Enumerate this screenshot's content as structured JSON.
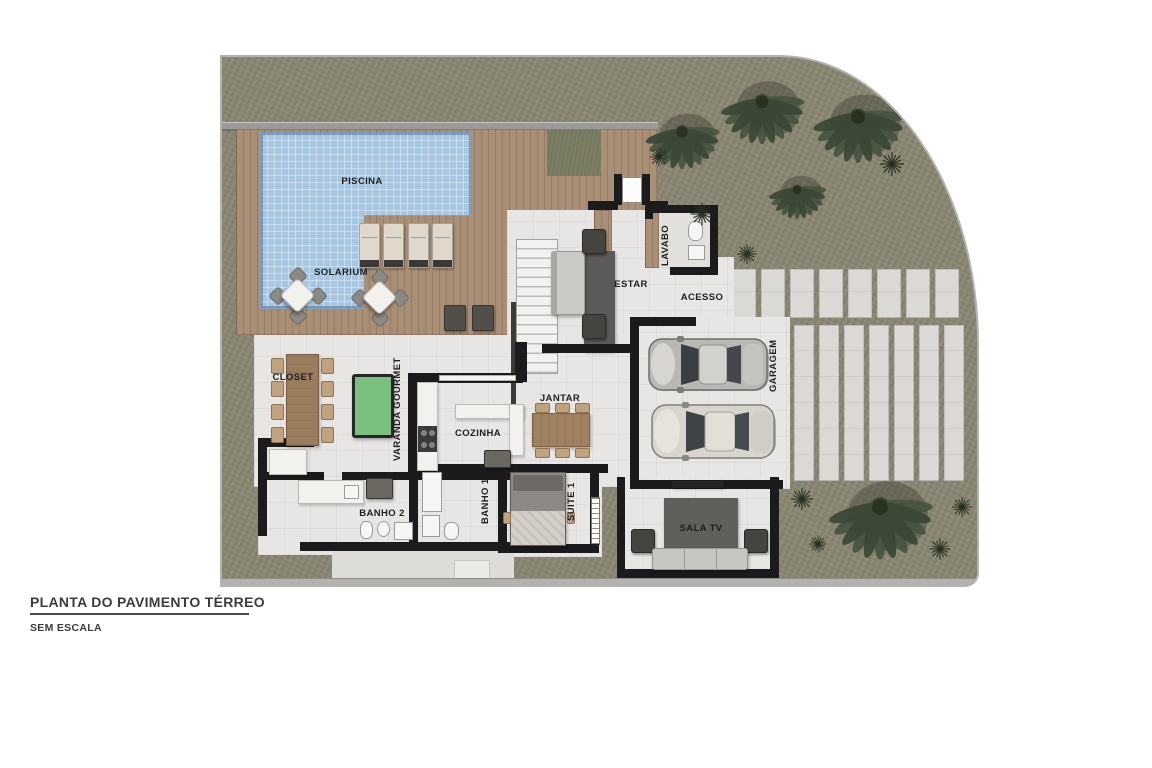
{
  "title_block": {
    "title": "PLANTA DO PAVIMENTO TÉRREO",
    "subtitle": "SEM ESCALA"
  },
  "labels": {
    "piscina": "PISCINA",
    "solarium": "SOLARIUM",
    "estar": "ESTAR",
    "lavabo": "LAVABO",
    "acesso": "ACESSO",
    "garagem": "GARAGEM",
    "closet": "CLOSET",
    "varanda_gourmet": "VARANDA GOURMET",
    "cozinha": "COZINHA",
    "jantar": "JANTAR",
    "banho2": "BANHO 2",
    "banho1": "BANHO 1",
    "suite1": "SUITE 1",
    "sala_tv": "SALA TV"
  },
  "colors": {
    "page_bg": "#ffffff",
    "grass": "#8a8773",
    "deck_wood": "#a98f76",
    "pool_water": "#a6c6e2",
    "floor": "#e7e6e4",
    "wall": "#1b1b1d",
    "slab": "#dbd9d5",
    "pool_table_felt": "#7cc07f",
    "rug": "#5b5a58",
    "palm": "#42503f",
    "boundary": "#b4b2ae",
    "text": "#1f1f1f"
  }
}
